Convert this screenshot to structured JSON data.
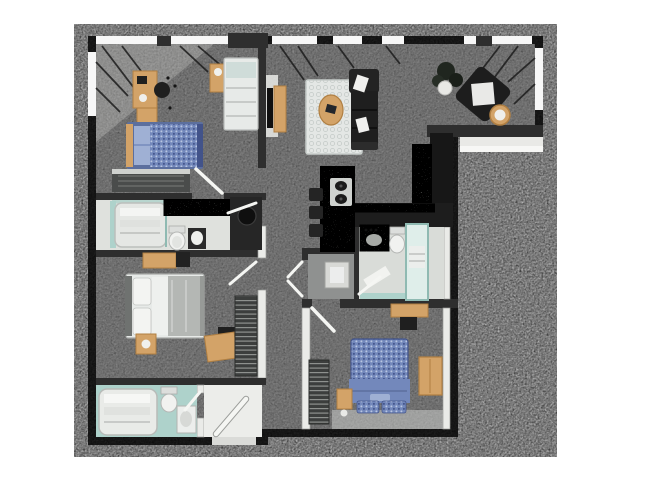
{
  "image_type": "3D top-down architectural floor plan rendering of a 3-bedroom / 3-bathroom apartment, no text labels",
  "palette": {
    "background": "#ffffff",
    "wall_dark": "#2e2e2e",
    "wall_light": "#eaebe8",
    "floor_concrete": "#9c9c9c",
    "floor_concrete_dark": "#8f9190",
    "floor_light": "#dfe1dd",
    "entry_floor": "#ecedea",
    "teal": "#aed2cb",
    "teal_dark": "#8fbab2",
    "shower_glass": "#dfeeea",
    "wood": "#d3a368",
    "wood_dark": "#b07f42",
    "bed_blue": "#7388bb",
    "bed_blue_light": "#9fb0d4",
    "bed_blue_dark": "#5c6f9e",
    "bedding_white": "#e7eae8",
    "blanket_gray": "#b4b7b4",
    "furniture_black": "#1f1f1f",
    "dresser_gray": "#4a4c4b",
    "granite": "#b9bcb8",
    "rug": "#e4e7e5",
    "window_white": "#f7f7f7",
    "door_white": "#f5f6f3",
    "fixture_white": "#f1f2f0"
  },
  "floor_plan": {
    "style": "dark charcoal walls, gray concrete floors, white interior partitions, corner windows top and upper-right",
    "rooms": [
      {
        "name": "bedroom-1",
        "location": "top-left",
        "furniture": [
          "desk with black chair",
          "tan nightstands",
          "bed with blue bedding",
          "second bed with white bedding",
          "slatted dresser"
        ]
      },
      {
        "name": "bathroom-1",
        "location": "mid-left",
        "furniture": [
          "tub shower with towels",
          "granite vanity",
          "toilet",
          "dark sink cabinet",
          "black utility closet"
        ]
      },
      {
        "name": "bedroom-2",
        "location": "lower-left",
        "furniture": [
          "tan dresser",
          "bed with white pillows and gray blanket",
          "nightstand with lamp",
          "small desk with black chair",
          "shelving unit"
        ]
      },
      {
        "name": "bathroom-3",
        "location": "bottom-left",
        "furniture": [
          "bathtub with towels",
          "toilet",
          "sink"
        ],
        "floor": "teal tile"
      },
      {
        "name": "entry",
        "location": "bottom-center-left",
        "furniture": [
          "open front door"
        ]
      },
      {
        "name": "living-room",
        "location": "top-center",
        "furniture": [
          "wall TV with wood console",
          "patterned area rug",
          "oval coffee table",
          "black sectional sofa with white pillows"
        ]
      },
      {
        "name": "sitting-nook",
        "location": "top-right",
        "furniture": [
          "black accent chair rotated",
          "potted plant",
          "round side table"
        ]
      },
      {
        "name": "kitchen",
        "location": "center",
        "furniture": [
          "granite island with cooktop",
          "three bar stools",
          "black refrigerator and tall cabinets",
          "L-shaped counter"
        ]
      },
      {
        "name": "bathroom-2",
        "location": "center-right",
        "furniture": [
          "granite sink vanity",
          "toilet",
          "teal glass shower",
          "bath mat"
        ]
      },
      {
        "name": "laundry-closet",
        "location": "center",
        "furniture": [
          "washer box",
          "double doors"
        ]
      },
      {
        "name": "bedroom-3",
        "location": "bottom-right",
        "furniture": [
          "desk with black chair",
          "bed with patterned blue bedding",
          "tan nightstand",
          "tan wardrobe",
          "shelving unit"
        ]
      }
    ],
    "window_walls": [
      "top wall of bedroom-1",
      "left wall of bedroom-1",
      "top wall of living room",
      "top and right walls of sitting nook"
    ]
  }
}
